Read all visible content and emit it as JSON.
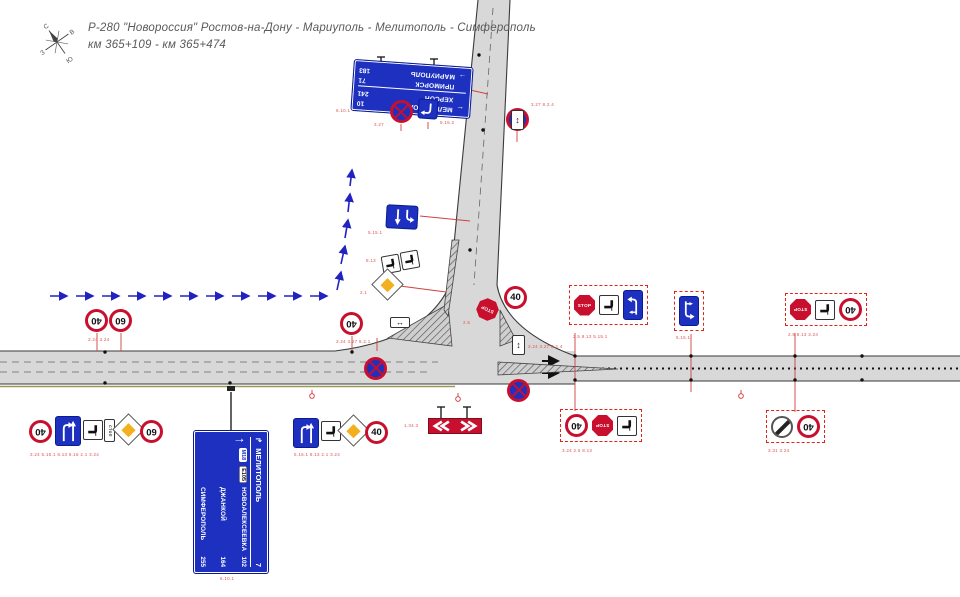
{
  "header": {
    "route": "Р-280 \"Новороссия\" Ростов-на-Дону - Мариуполь - Мелитополь - Симферополь",
    "km": "км 365+109 - км 365+474"
  },
  "compass": {
    "n": "С",
    "e": "В",
    "s": "Ю",
    "w": "З"
  },
  "signs": {
    "speed40": "40",
    "speed60": "60",
    "stop": "STOP",
    "stop_ru": "СТОП",
    "arrow_updown": "↕",
    "arrow_leftright": "↔"
  },
  "north_board": {
    "rows": [
      {
        "arrow": "←",
        "name": "МЕЛИТОПОЛЬ",
        "dist": "10"
      },
      {
        "arrow": "",
        "name": "ХЕРСОН",
        "dist": "241"
      },
      {
        "arrow": "",
        "name": "ПРИМОРСК",
        "dist": "71"
      },
      {
        "arrow": "→",
        "name": "МАРИУПОЛЬ",
        "dist": "183"
      }
    ]
  },
  "south_board": {
    "top_arrow": "↱",
    "top_name": "МЕЛИТОПОЛЬ",
    "top_dist": "7",
    "main_arrow": "↑",
    "badge1": "М18",
    "badge2": "Е105",
    "rows": [
      {
        "name": "НОВОАЛЕКСЕЕВКА",
        "dist": "102"
      },
      {
        "name": "ДЖАНКОЙ",
        "dist": "164"
      },
      {
        "name": "СИМФЕРОПОЛЬ",
        "dist": "255"
      }
    ]
  },
  "codes": {
    "a": "6.10.1",
    "b": "5.15.2",
    "c": "3.27",
    "d": "3.27  8.2.4",
    "e": "5.15.1",
    "f": "8.13",
    "g": "2.1",
    "h": "3.24   3.24",
    "i": "3.24  3.27  8.2.1",
    "j": "2.5",
    "j2": "3.24  3.27  8.2.4",
    "k": "2.5  8.13  5.15.1",
    "l": "5.15.1",
    "m": "2.5  8.13  3.24",
    "n": "3.24  5.15.1  8.13  6.16  2.1  3.24",
    "o": "5.15.1  8.13  2.1  3.24",
    "p": "1.34.3",
    "q": "3.24  2.5  8.13",
    "r": "3.31  3.24",
    "s": "6.10.1"
  }
}
